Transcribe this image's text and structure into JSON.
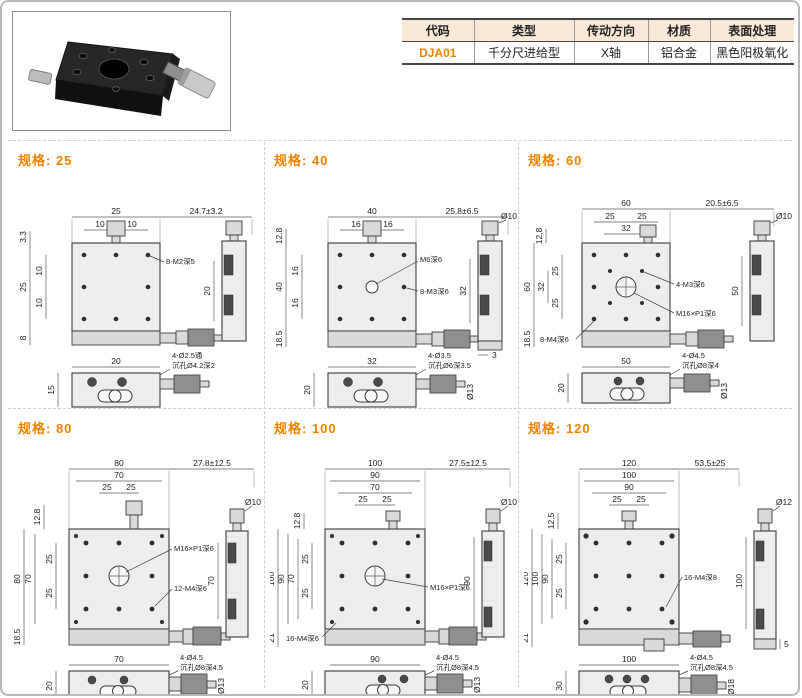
{
  "colors": {
    "accent": "#ef8200",
    "table_header_bg": "#fbe9d8",
    "drawing_line": "#5a5a5a",
    "body_fill": "#ededed",
    "divider_dashed": "#cfcfcf"
  },
  "table": {
    "headers": [
      "代码",
      "类型",
      "传动方向",
      "材质",
      "表面处理"
    ],
    "row": [
      "DJA01",
      "千分尺进给型",
      "X轴",
      "铝合金",
      "黑色阳极氧化"
    ]
  },
  "photo": {
    "description": "black-micrometer-stage-photo"
  },
  "specs": [
    {
      "label": "规格: 25",
      "dims": {
        "top1": "25",
        "sub1": "10",
        "sub2": "10",
        "travel": "24.7±3.2",
        "ltop": "3.3",
        "l1": "10",
        "l2": "25",
        "l3": "10",
        "lbot": "8",
        "c1": "8-M2深5",
        "slen": "20",
        "bw": "20",
        "bh": "15",
        "bc1": "4-Ø2.5通",
        "bc2": "沉孔Ø4.2深2"
      }
    },
    {
      "label": "规格: 40",
      "dims": {
        "top1": "40",
        "sub1": "16",
        "sub2": "16",
        "travel": "25.8±6.5",
        "ltop": "12.8",
        "l1": "16",
        "l2": "40",
        "l3": "16",
        "lbot": "18.5",
        "c1": "M6深6",
        "c2": "8-M3深6",
        "sdia": "Ø10",
        "slen": "32",
        "sext": "3",
        "bw": "32",
        "bh": "20",
        "bc1": "4-Ø3.5",
        "bc2": "沉孔Ø6深3.5",
        "bdia": "Ø13"
      }
    },
    {
      "label": "规格: 60",
      "dims": {
        "top1": "60",
        "sub1": "25",
        "sub2": "25",
        "sub3": "32",
        "travel": "20.5±6.5",
        "ltop": "12.8",
        "l1": "25",
        "l2": "32",
        "l3": "60",
        "l4": "25",
        "lbot": "18.5",
        "c1": "4-M3深6",
        "c2": "M16×P1深6",
        "c3": "8-M4深6",
        "sdia": "Ø10",
        "slen": "50",
        "bw": "50",
        "bh": "20",
        "bc1": "4-Ø4.5",
        "bc2": "沉孔Ø8深4",
        "bdia": "Ø13"
      }
    },
    {
      "label": "规格: 80",
      "dims": {
        "top1": "80",
        "top2": "70",
        "sub1": "25",
        "sub2": "25",
        "travel": "27.8±12.5",
        "ltop": "12.8",
        "l1": "80",
        "l2": "70",
        "l3": "25",
        "l4": "25",
        "lbot": "18.5",
        "c1": "M16×P1深6",
        "c2": "12-M4深6",
        "sdia": "Ø10",
        "slen": "70",
        "bw": "70",
        "bh": "20",
        "bc1": "4-Ø4.5",
        "bc2": "沉孔Ø8深4.5",
        "bdia": "Ø13"
      }
    },
    {
      "label": "规格: 100",
      "dims": {
        "top1": "100",
        "top2": "90",
        "top3": "70",
        "sub1": "25",
        "sub2": "25",
        "travel": "27.5±12.5",
        "ltop": "12.8",
        "l1": "100",
        "l2": "90",
        "l3": "70",
        "l4": "25",
        "l5": "25",
        "lbot": "21",
        "c1": "M16×P1深6",
        "c2": "16-M4深6",
        "sdia": "Ø10",
        "slen": "90",
        "bw": "90",
        "bh": "20",
        "bc1": "4-Ø4.5",
        "bc2": "沉孔Ø8深4.5",
        "bdia": "Ø13"
      }
    },
    {
      "label": "规格: 120",
      "dims": {
        "top1": "120",
        "top2": "100",
        "top3": "90",
        "sub1": "25",
        "sub2": "25",
        "travel": "53.5±25",
        "ltop": "12.5",
        "l1": "120",
        "l2": "100",
        "l3": "90",
        "l4": "25",
        "l5": "25",
        "lbot": "21",
        "c1": "16-M4深8",
        "sdia": "Ø12",
        "slen": "100",
        "sext": "5",
        "bw": "100",
        "bh": "30",
        "bc1": "4-Ø4.5",
        "bc2": "沉孔Ø8深4.5",
        "bdia": "Ø18"
      }
    }
  ]
}
